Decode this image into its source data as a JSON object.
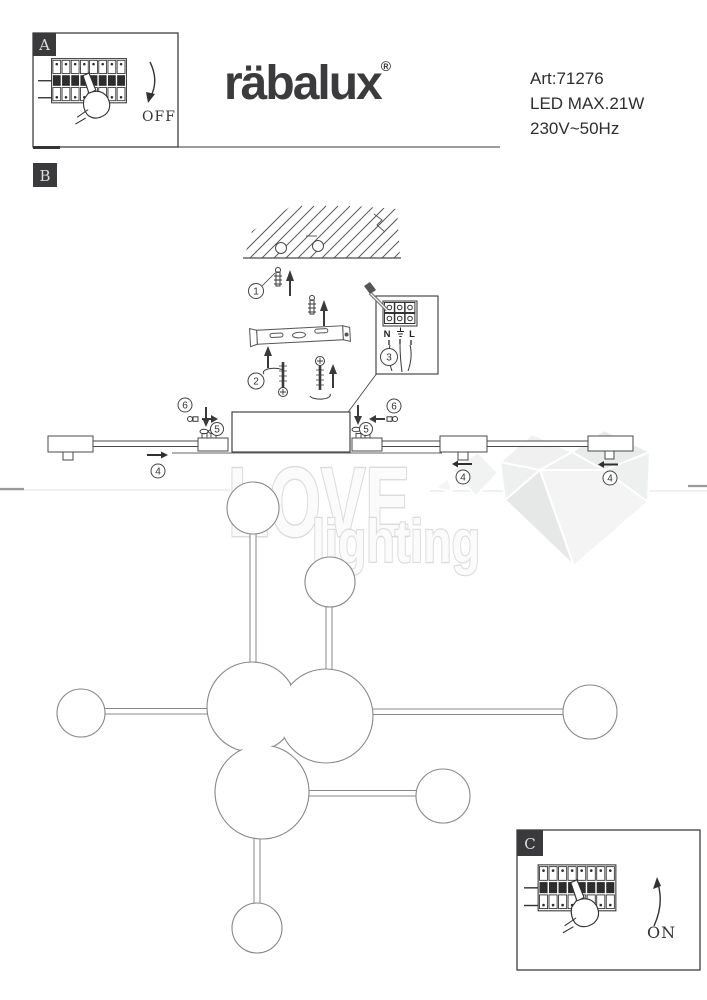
{
  "brand": {
    "logo_text": "räbalux",
    "registered_mark": "®",
    "logo_color": "#3b3b3d"
  },
  "product": {
    "article": "Art:71276",
    "power": "LED MAX.21W",
    "voltage": "230V~50Hz"
  },
  "sections": {
    "a_label": "A",
    "b_label": "B",
    "c_label": "C"
  },
  "breaker": {
    "off_label": "OFF",
    "on_label": "ON"
  },
  "steps": {
    "s1": "1",
    "s2": "2",
    "s3": "3",
    "s4": "4",
    "s5": "5",
    "s6": "6"
  },
  "wiring": {
    "neutral_label": "N",
    "live_label": "L",
    "earth_icon": "⏚"
  },
  "watermark": {
    "line1": "LOVE",
    "line2": "lighting"
  }
}
